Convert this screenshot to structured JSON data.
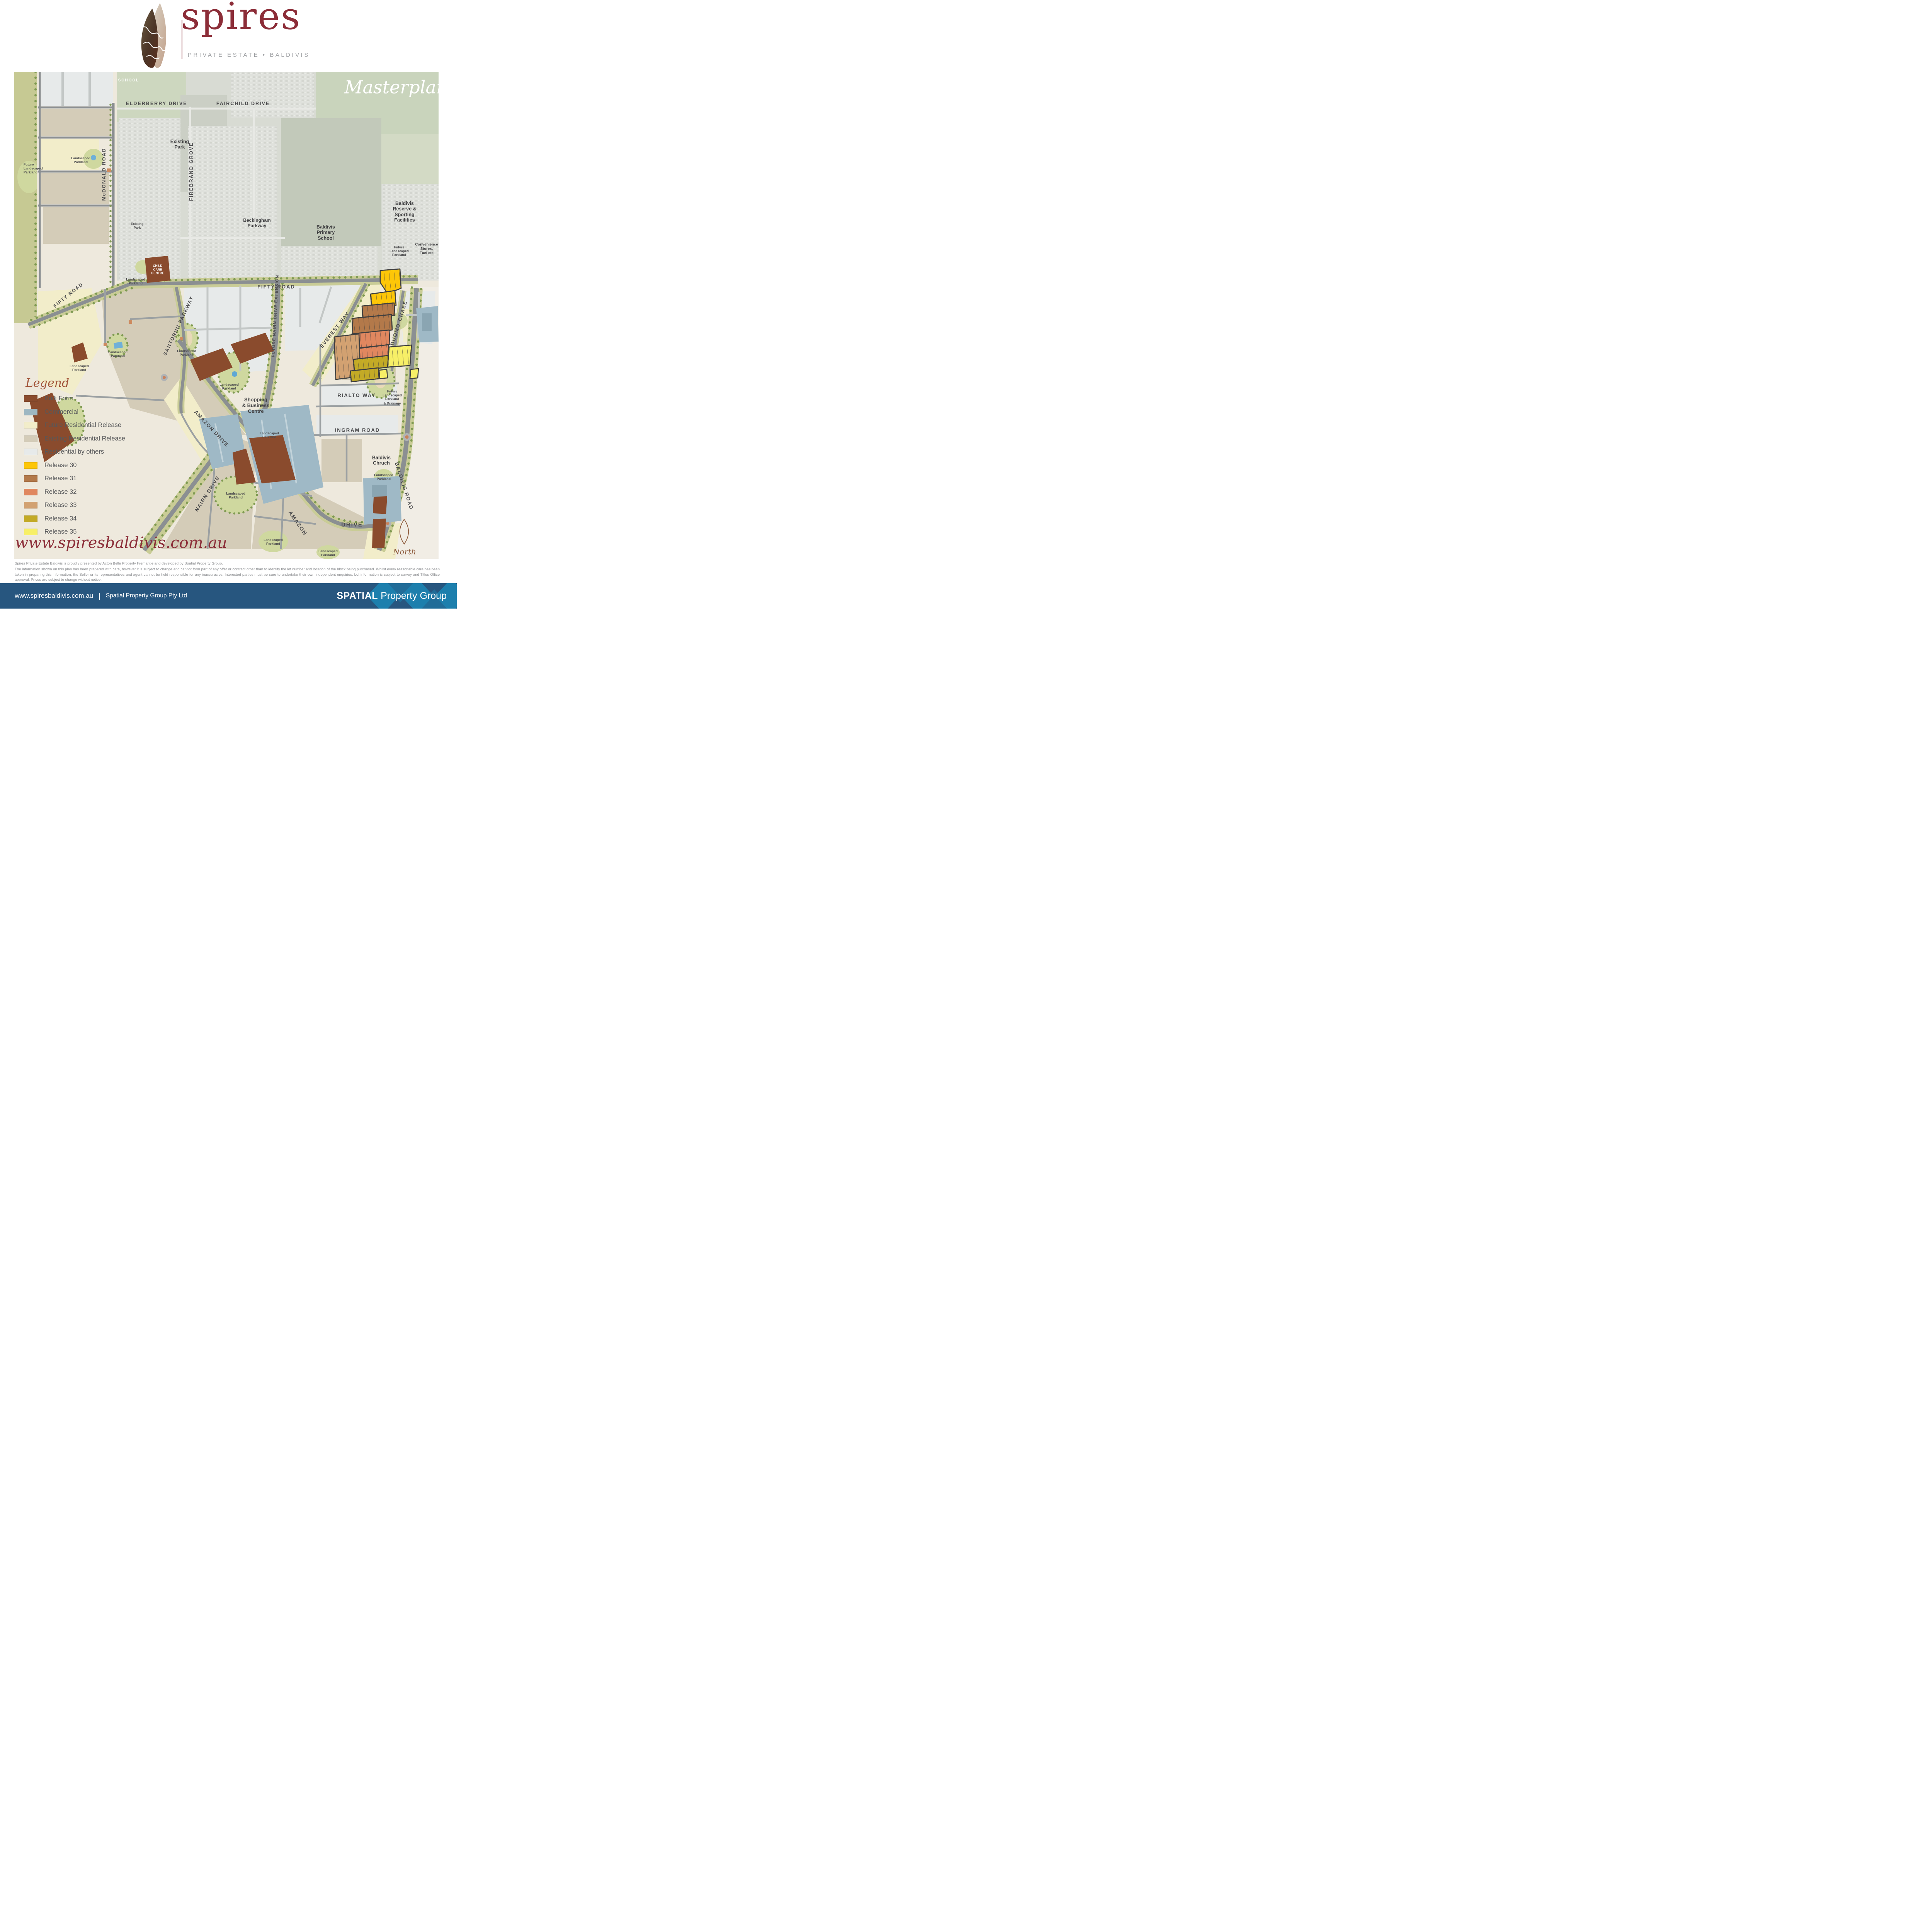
{
  "header": {
    "logo": "spires",
    "tagline": "PRIVATE ESTATE • BALDIVIS"
  },
  "map": {
    "title": "Masterplan",
    "labels": {
      "school": "SCHOOL",
      "elderberry": "ELDERBERRY  DRIVE",
      "fairchild": "FAIRCHILD  DRIVE",
      "existing_park": "Existing\nPark",
      "firebrand": "FIREBRAND  GROVE",
      "mcdonald": "McDONALD  ROAD",
      "beckingham": "Beckingham\nParkway",
      "primary_school": "Baldivis\nPrimary\nSchool",
      "reserve": "Baldivis Reserve &\nSporting Facilities",
      "fifty_road": "FIFTY  ROAD",
      "convenience": "Convenience\nStores,\nFuel etc",
      "child_care": "CHILD\nCARE\nCENTRE",
      "santorini": "SANTORINI  PARKWAY",
      "future_nairn": "FUTURE NAIRN DRIVE EXTENSION",
      "everest": "EVEREST  WAY",
      "duomo": "DUOMO  CHASE",
      "shopping": "Shopping\n& Business\nCentre",
      "amazon_drive": "AMAZON  DRIVE",
      "rialto": "RIALTO  WAY",
      "ingram": "INGRAM  ROAD",
      "church": "Baldivis\nChruch",
      "baldivis_road": "BALDIVIS  ROAD",
      "nairn": "NAIRN  DRIVE",
      "amazon": "AMAZON",
      "drive": "DRIVE",
      "landscaped_parkland": "Landscaped\nParkland",
      "future_landscaped_parkland": "Future\nLandscaped\nParkland",
      "drainage": "Future\nLandscaped\nParkland\n& Drainage",
      "north": "North"
    }
  },
  "legend": {
    "title": "Legend",
    "items": [
      {
        "label": "Built Form",
        "color": "#8a4b2d"
      },
      {
        "label": "Commercial",
        "color": "#9db7c2"
      },
      {
        "label": "Future Residential Release",
        "color": "#f2edca"
      },
      {
        "label": "Existing Residential Release",
        "color": "#d4ccb8"
      },
      {
        "label": "Residential by others",
        "color": "#e7eaea"
      },
      {
        "label": "Release 30",
        "color": "#fdc608"
      },
      {
        "label": "Release 31",
        "color": "#b3794a"
      },
      {
        "label": "Release 32",
        "color": "#e0875f"
      },
      {
        "label": "Release 33",
        "color": "#d2a171"
      },
      {
        "label": "Release 34",
        "color": "#c3aa26"
      },
      {
        "label": "Release 35",
        "color": "#f7ef67"
      }
    ]
  },
  "website": "www.spiresbaldivis.com.au",
  "disclaimer": {
    "line1": "Spires Private Estate Baldivis is proudly presented by Acton Belle Property Fremantle and developed by Spatial Property Group.",
    "body": "The information shown on this plan has been prepared with care, however it is subject to change and cannot form part of any offer or contract other than to identify the lot number and location of the block being purchased. Whilst every reasonable care has been taken in preparing this information, the Seller or its representatives and agent cannot be held responsible for any inaccuracies. Interested parties must be sure to undertake their own independent enquiries. Lot information is subject to survey and Titles Office approval. Prices are subject to change without notice."
  },
  "footer": {
    "url": "www.spiresbaldivis.com.au",
    "separator": "|",
    "company": "Spatial Property Group Pty Ltd",
    "brand_bold": "SPATIAL",
    "brand_light": "Property Group"
  },
  "colors": {
    "maroon": "#8c2e39",
    "footer_blue": "#27567f",
    "footer_pattern_blue": "#1d7fad"
  }
}
